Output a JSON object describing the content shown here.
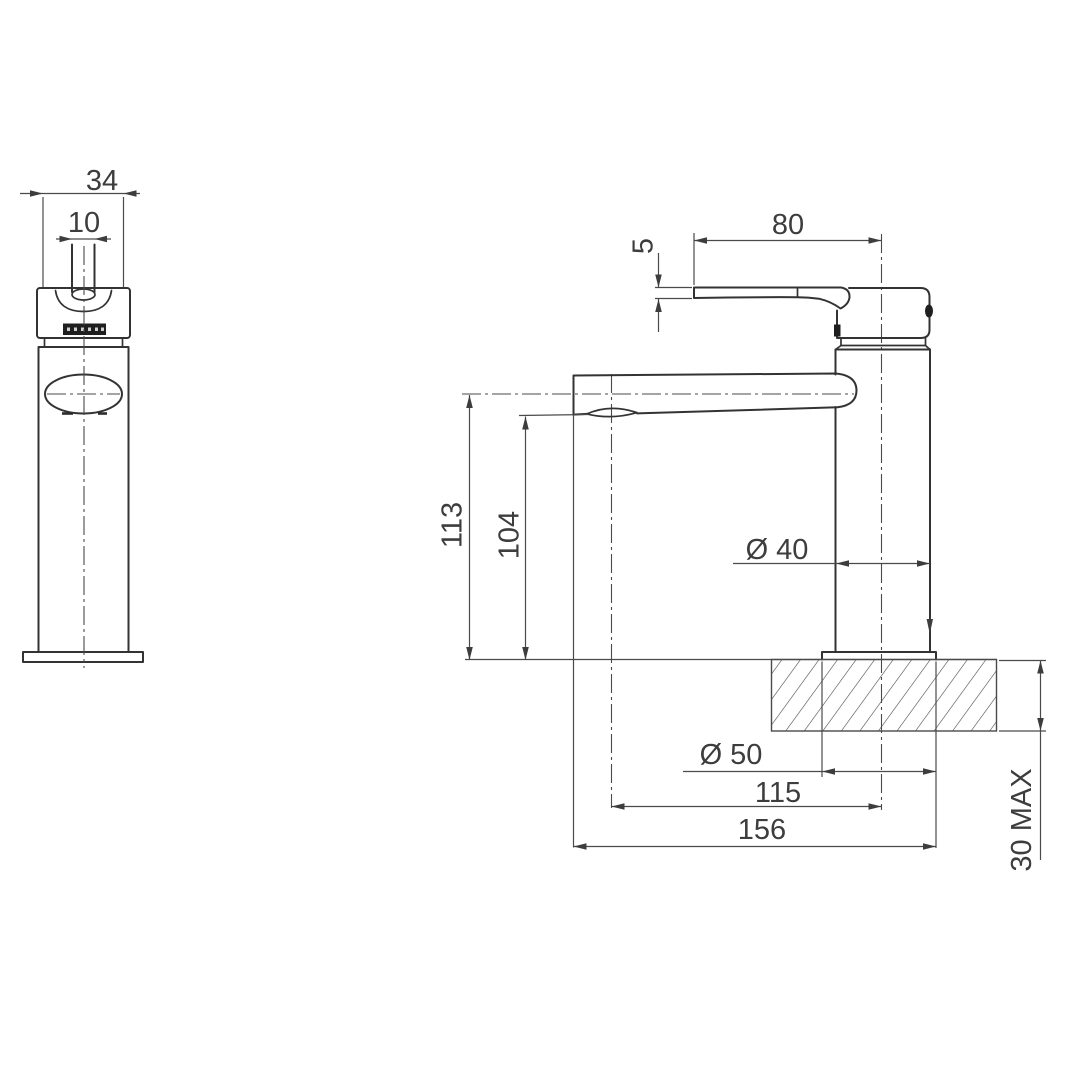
{
  "page": {
    "background": "#ffffff",
    "outline_color": "#333333",
    "thin_line_color": "#4a4a4a",
    "text_color": "#3d3d3d"
  },
  "dims": {
    "d34": "34",
    "d10": "10",
    "d80": "80",
    "d5": "5",
    "d113": "113",
    "d104": "104",
    "d40": "Ø 40",
    "d50": "Ø 50",
    "d115": "115",
    "d156": "156",
    "d30max": "30 MAX"
  }
}
